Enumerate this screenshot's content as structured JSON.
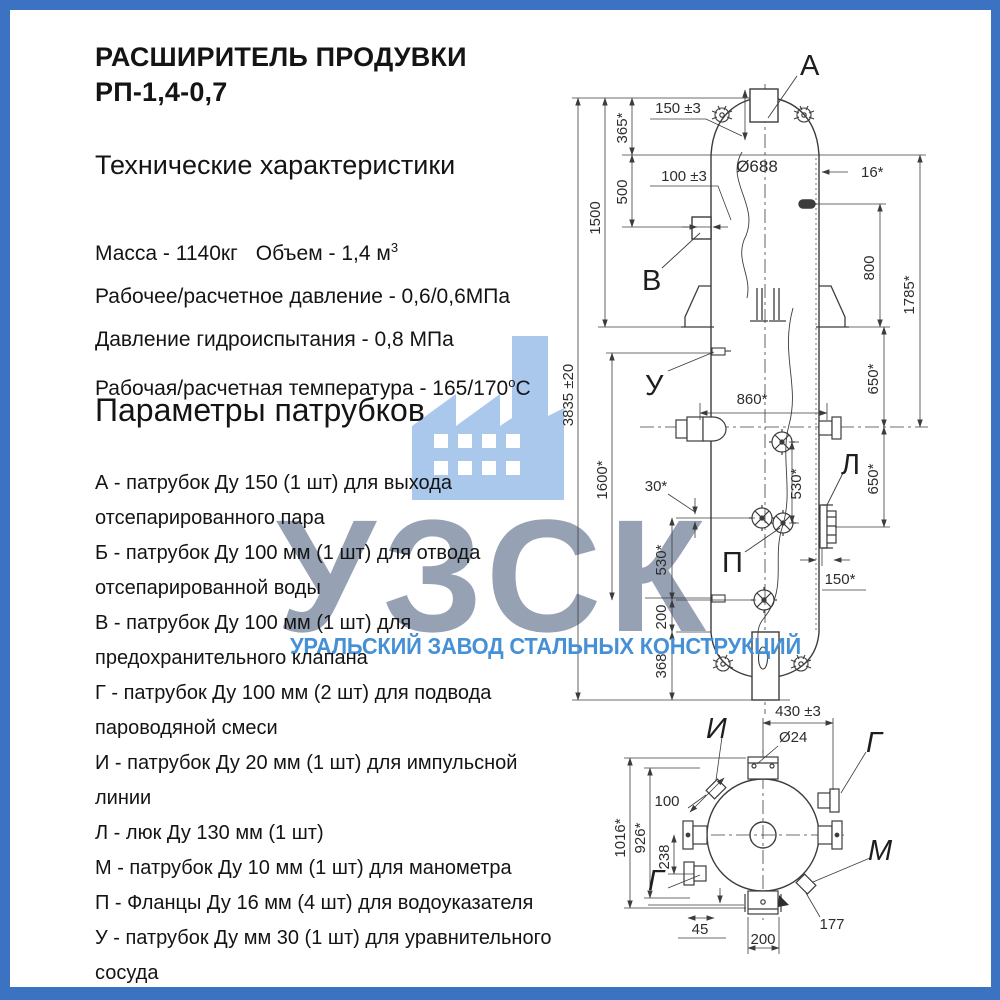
{
  "page": {
    "frame_color": "#3c72c2",
    "line_color": "#3c3c3c",
    "accent_blue": "#4690d5",
    "watermark_gray": "#6e7e98",
    "watermark_icon_blue": "#a9c8ec"
  },
  "header": {
    "title_line1": "РАСШИРИТЕЛЬ ПРОДУВКИ",
    "title_line2": "РП-1,4-0,7"
  },
  "specs": {
    "heading": "Технические характеристики",
    "mass": "Масса - 1140кг",
    "volume_prefix": "Объем - 1,4 м",
    "volume_sup": "3",
    "line2": "Рабочее/расчетное давление - 0,6/0,6МПа",
    "line3": "Давление гидроиспытания - 0,8 МПа",
    "temp_prefix": "Рабочая/расчетная температура - 165/170",
    "temp_sup": "о",
    "temp_suffix": "С"
  },
  "nozzles": {
    "heading": "Параметры патрубков",
    "items": [
      "А - патрубок Ду 150 (1 шт) для выхода отсепарированного пара",
      "Б - патрубок Ду 100 мм (1 шт) для отвода отсепарированной воды",
      "В - патрубок Ду 100 мм (1 шт) для предохранительного клапана",
      "Г - патрубок Ду 100 мм (2 шт) для подвода пароводяной смеси",
      "И - патрубок Ду 20 мм (1 шт) для импульсной линии",
      "Л - люк Ду 130 мм (1 шт)",
      "М - патрубок Ду 10 мм (1 шт) для манометра",
      "П - Фланцы Ду 16 мм (4 шт) для водоуказателя",
      "У - патрубок Ду мм 30 (1 шт) для уравнительного сосуда"
    ]
  },
  "watermark": {
    "letters": "УЗСК",
    "subtitle": "УРАЛЬСКИЙ ЗАВОД СТАЛЬНЫХ КОНСТРУКЦИЙ",
    "icon": "factory-icon"
  },
  "drawing": {
    "front": {
      "label_a": "А",
      "label_v": "В",
      "label_u": "У",
      "label_l": "Л",
      "label_p": "П",
      "h_total": "3835 ±20",
      "d1500": "1500",
      "d1600": "1600*",
      "d365": "365*",
      "d500": "500",
      "d150": "150 ±3",
      "d100": "100 ±3",
      "dia": "Ø688",
      "wall": "16*",
      "d800": "800",
      "d1785": "1785*",
      "d650a": "650*",
      "d650b": "650*",
      "d860": "860*",
      "d30": "30*",
      "d530r": "530*",
      "d530l": "530*",
      "d200": "200",
      "d368": "368",
      "d150r": "150*"
    },
    "top": {
      "label_i": "И",
      "label_g1": "Г",
      "label_m": "М",
      "label_g2": "Г",
      "d430": "430 ±3",
      "dia24": "Ø24",
      "d100": "100",
      "d1016": "1016*",
      "d926": "926*",
      "d238": "238",
      "d45": "45",
      "d200": "200",
      "d177": "177"
    }
  }
}
